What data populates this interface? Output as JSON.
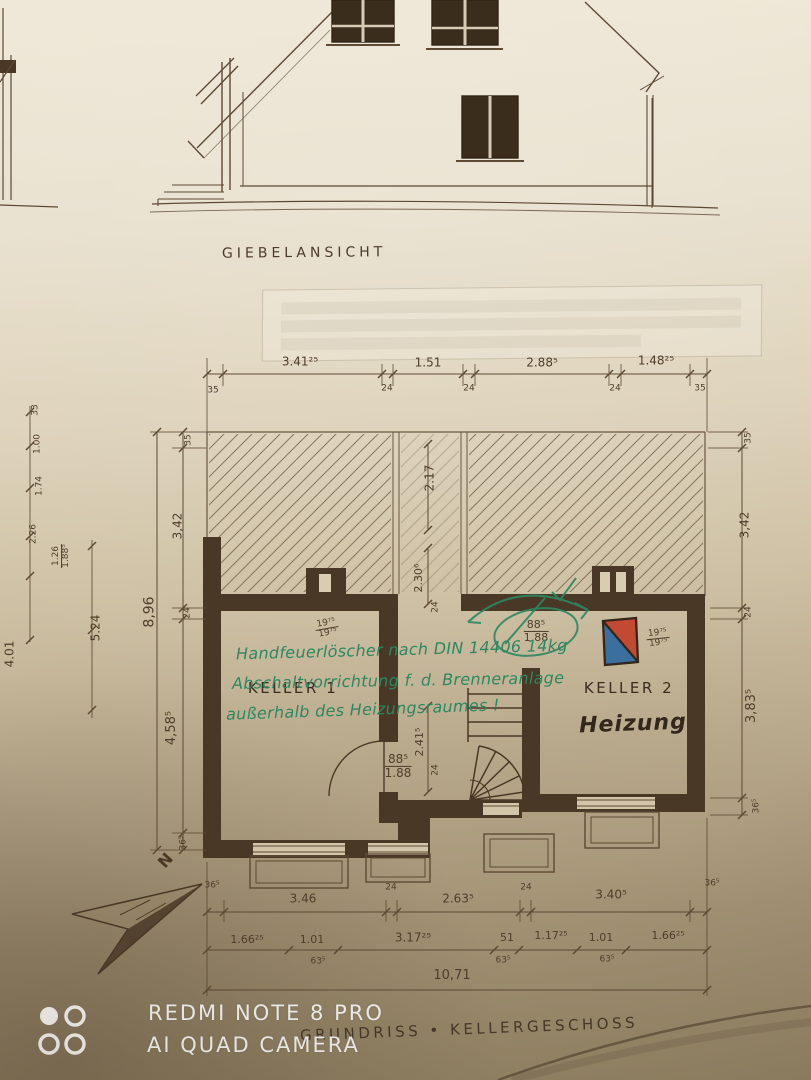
{
  "photo": {
    "watermark_line1": "REDMI NOTE 8 PRO",
    "watermark_line2": "AI QUAD CAMERA"
  },
  "elevation": {
    "label": "GIEBELANSICHT"
  },
  "plan": {
    "caption": "GRUNDRISS • KELLERGESCHOSS",
    "north_letter": "N",
    "rooms": {
      "keller1": "KELLER 1",
      "keller2": "KELLER 2",
      "heizung": "Heizung"
    },
    "green_notes": {
      "line1": "Handfeuerlöscher nach DIN 14406 14kg",
      "line2": "Abschaltvorrichtung f. d. Brenneranlage",
      "line3": "außerhalb des Heizungsraumes !"
    }
  },
  "dims": {
    "top": [
      "35",
      "3.41²⁵",
      "24",
      "1.51",
      "24",
      "2.88⁵",
      "24",
      "1.48²⁵",
      "35"
    ],
    "bottom_row1": [
      "36⁵",
      "3.46",
      "24",
      "2.63⁵",
      "24",
      "3.40⁵",
      "36⁵"
    ],
    "bottom_row2": [
      "1.66²⁵",
      "1.01",
      "3.17²⁵",
      "51",
      "1.17²⁵",
      "1.01",
      "1.66²⁵"
    ],
    "bottom_row2_sub": [
      "63⁵",
      "63⁵",
      "63⁵"
    ],
    "bottom_total": "10,71",
    "left": [
      "35",
      "3,42",
      "24",
      "4,58⁵",
      "36⁵"
    ],
    "left_total": "8,96",
    "right": [
      "35",
      "3,42",
      "24",
      "3,83⁵",
      "36⁵"
    ],
    "corridor_width_top": "2.17",
    "corridor_a": "2.30⁶",
    "corridor_a_wall": "24",
    "corridor_b": "2.41⁵",
    "corridor_b_wall": "24",
    "door_keller1": {
      "width": "88⁵",
      "height": "1.88"
    },
    "door_keller2": {
      "width": "88⁵",
      "height": "1.88"
    },
    "opening_keller1": {
      "top": "19⁷⁵",
      "bottom": "19⁷⁵"
    },
    "opening_keller2": {
      "top": "19⁷⁵",
      "bottom": "19⁷⁵"
    },
    "adjacent_sheet": [
      "33",
      "1.00",
      "1.74",
      "2.26",
      "1.26",
      "1.88⁵",
      "5.24",
      "4.01"
    ]
  },
  "colors": {
    "ink": "#5a4734",
    "wall_fill": "#4a3827",
    "green_ink": "#2e8760",
    "boiler_red": "#c24a32",
    "boiler_blue": "#3a6f9f",
    "paper_light": "#ece5d4",
    "paper_dark": "#97876b"
  }
}
